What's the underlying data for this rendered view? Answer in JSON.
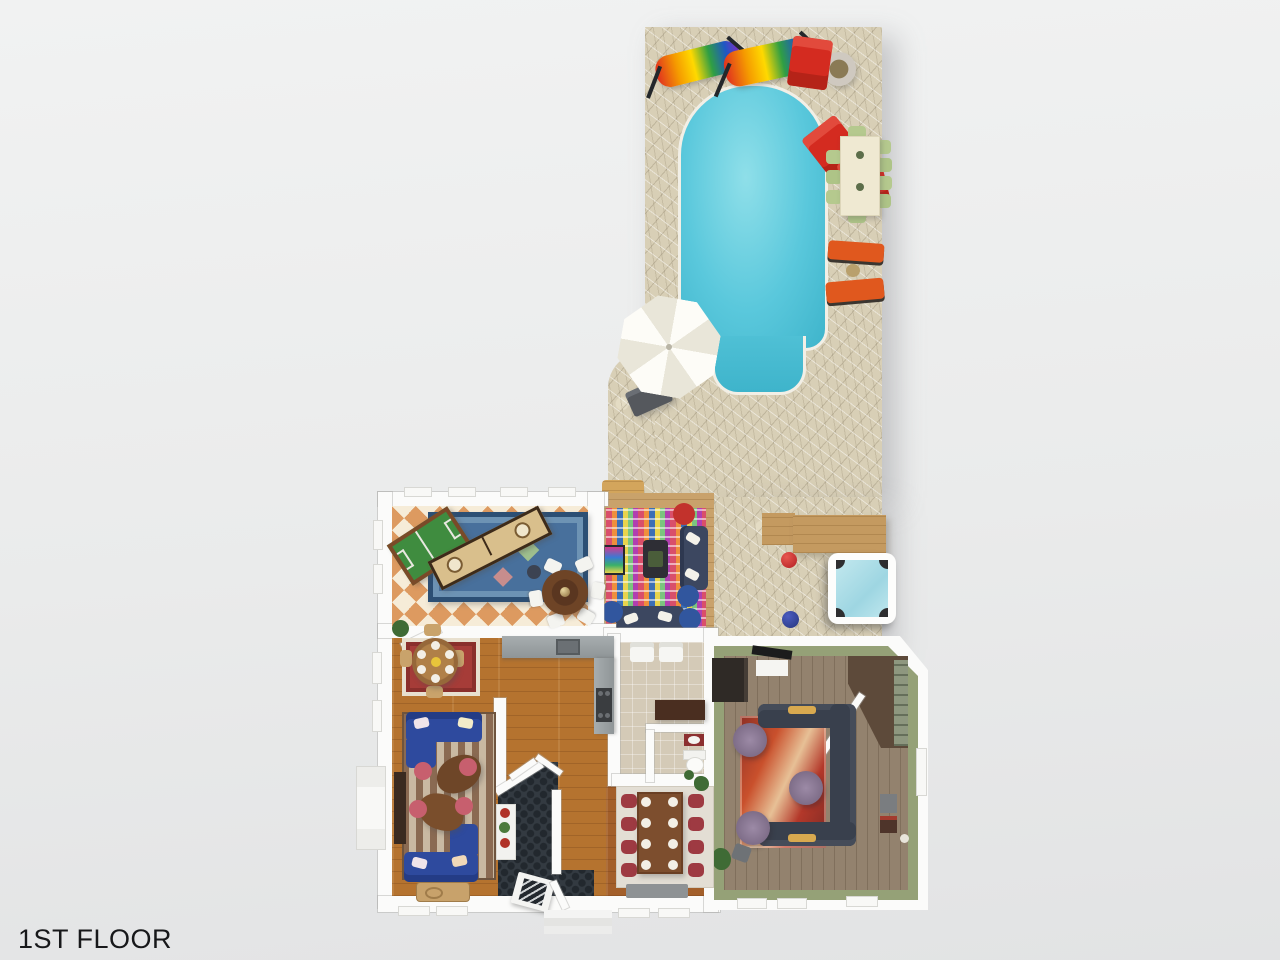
{
  "page": {
    "background": "#eceded",
    "floor_label": "1ST FLOOR"
  },
  "plan": {
    "view": "3d-top-down-floor-plan",
    "outdoor": {
      "patio": {
        "name": "flagstone pool patio",
        "color": "#d8cfb6"
      },
      "pool": {
        "name": "swimming pool",
        "water_color": "#5ac8db",
        "coping_color": "#f2efe6"
      },
      "hot_tub": {
        "name": "hot tub",
        "shell_color": "#ffffff",
        "water_color": "#a9dde6"
      },
      "furniture": [
        {
          "name": "rainbow hammock chair",
          "count": 2,
          "colors": [
            "#e03020",
            "#f59a00",
            "#ffd900",
            "#2f9e44",
            "#1f57c4"
          ]
        },
        {
          "name": "adirondack chair",
          "count": 3,
          "color": "#d42b20"
        },
        {
          "name": "fire pit",
          "ring_color": "#c9c4bc",
          "ember_color": "#8a7a55"
        },
        {
          "name": "outdoor dining table",
          "table_color": "#efe9d2",
          "chair_color": "#b5c98e",
          "seats": 9
        },
        {
          "name": "sun lounger",
          "count": 2,
          "color": "#e0581e"
        },
        {
          "name": "patio umbrella",
          "color": "#fdfcf7"
        },
        {
          "name": "garden bench",
          "color": "#55585d"
        },
        {
          "name": "red ball",
          "color": "#cc2a33"
        },
        {
          "name": "blue ball",
          "color": "#2e3f8f"
        },
        {
          "name": "wood step deck",
          "color": "#d3a55c"
        }
      ]
    },
    "lounge_deck": {
      "name": "outdoor lounge deck",
      "floor": "wood",
      "furniture": [
        "multicolor mosaic rug",
        "navy outdoor sofa x2",
        "fire table",
        "red pouf",
        "blue pouf x3",
        "abstract art panel",
        "white pillows"
      ]
    },
    "rooms": [
      {
        "name": "game room",
        "floor": "orange-cream diamond checker",
        "furniture": [
          "foosball table",
          "shuffleboard table",
          "blue oriental rug",
          "round poker table",
          "white chairs x6",
          "dark side chair"
        ]
      },
      {
        "name": "dining nook",
        "floor": "hardwood",
        "furniture": [
          "red oriental rug",
          "round wood table",
          "place settings x6",
          "wood chairs",
          "potted plant"
        ]
      },
      {
        "name": "living room",
        "floor": "hardwood",
        "furniture": [
          "striped rug",
          "blue sectional sofa x2",
          "organic wood coffee table x2",
          "rose pouf x4",
          "dark console",
          "woven bench"
        ]
      },
      {
        "name": "kitchen",
        "floor": "hardwood",
        "furniture": [
          "granite counter",
          "sink",
          "range"
        ]
      },
      {
        "name": "foyer",
        "floor": "dark hex tile",
        "furniture": [
          "staircase",
          "plant shelf with red pots",
          "front door",
          "open double doors"
        ]
      },
      {
        "name": "mudroom hall",
        "floor": "stone tile",
        "furniture": [
          "white armchair x2",
          "walnut console",
          "powder room toilet",
          "red vanity"
        ]
      },
      {
        "name": "formal dining room",
        "floor": "hardwood",
        "furniture": [
          "light rug",
          "long wood table",
          "maroon chairs x8",
          "place settings x8",
          "gray sideboard",
          "plant"
        ]
      },
      {
        "name": "family room",
        "wall_color": "#95a177",
        "floor": "gray-brown hardwood",
        "furniture": [
          "charcoal U-sectional",
          "abstract red rug",
          "purple tufted ottoman x3",
          "media console",
          "tv",
          "corner shelf nook",
          "side cabinet",
          "lamp",
          "plant",
          "gray pouf"
        ]
      }
    ]
  }
}
